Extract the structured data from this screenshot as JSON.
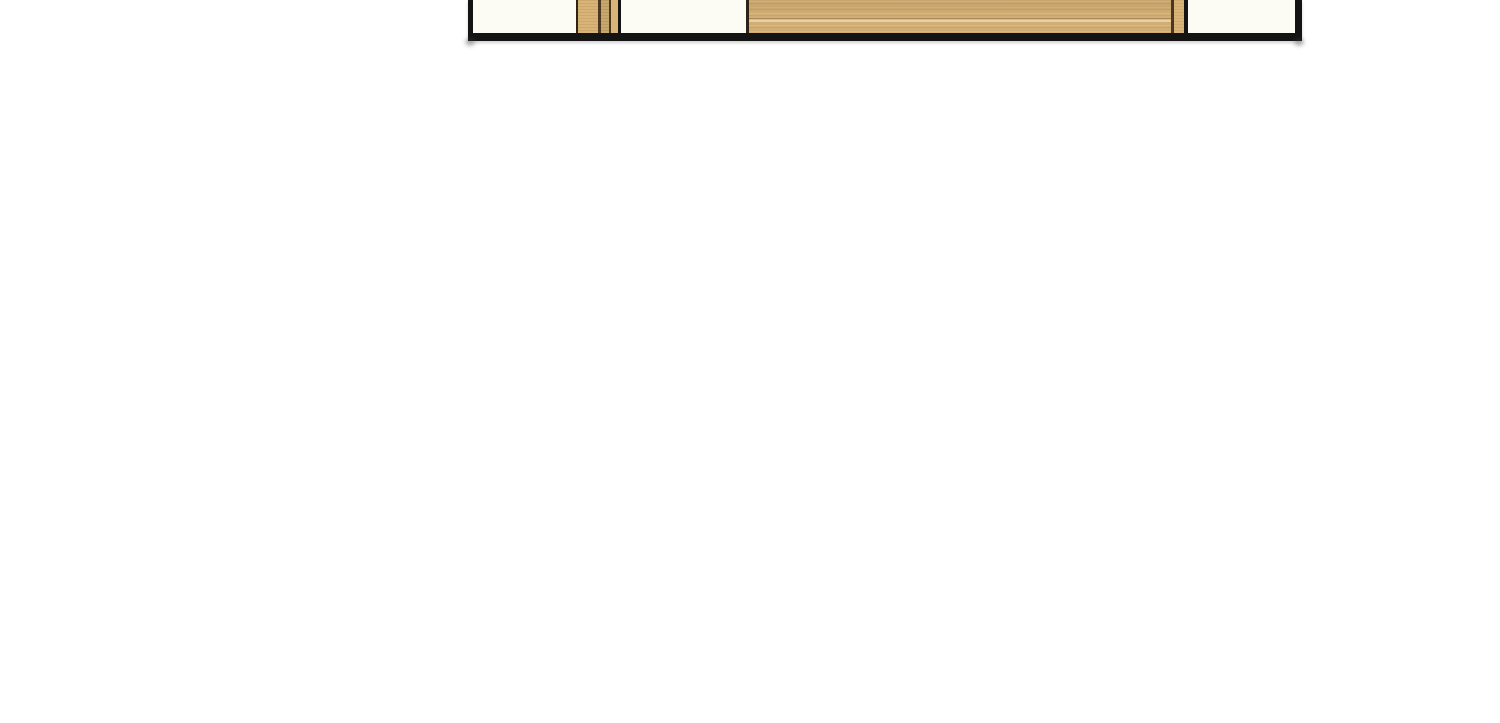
{
  "page": {
    "background": "#ffffff",
    "description": "Vertical-scroll comic reader page, mostly blank white; only the bottom sliver of one panel is visible at the top edge"
  },
  "comic_panel": {
    "description": "Bottom fragment of a hand-inked comic panel, cut off at the top of the screenshot: black frame borders, off-white interior, a striped wooden post at left and a wide wood-grain tabletop panel with a narrow plank near its right edge",
    "colors": {
      "ink": "#141414",
      "interior": "#fdfcf4",
      "wood-base": "#d8b478",
      "wood-stripe-dark": "#4c3822",
      "wood-stripe-olive": "#c6a76c",
      "outline-brown": "#2e2315",
      "page-bg": "#ffffff"
    }
  }
}
